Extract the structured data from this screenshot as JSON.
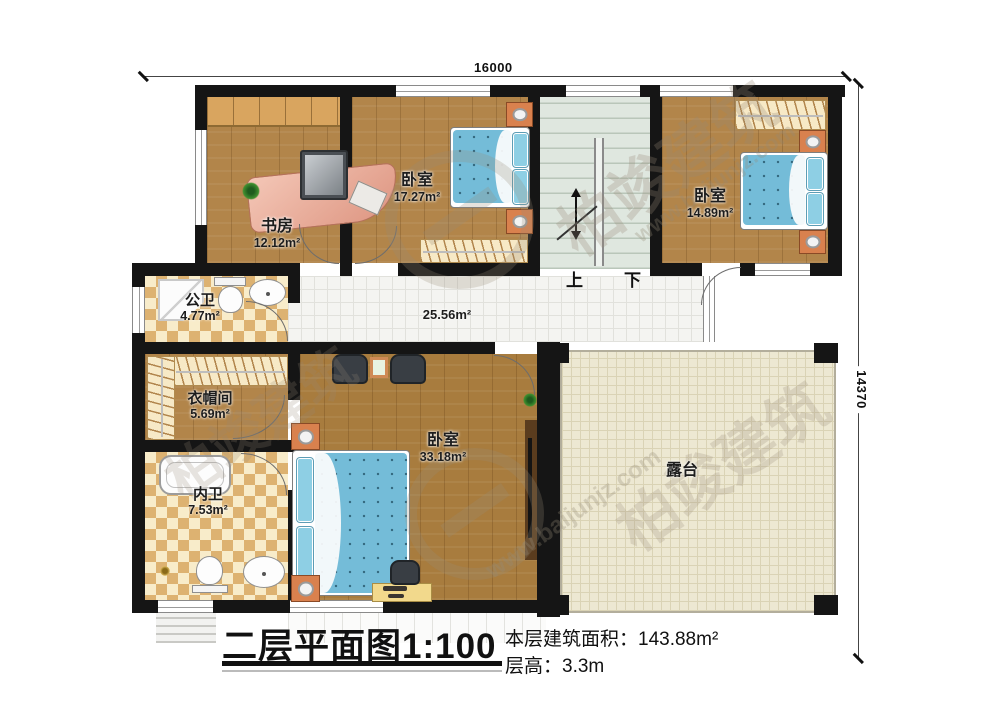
{
  "title_block": {
    "title": "二层平面图1:100",
    "area_label": "本层建筑面积：143.88m²",
    "floor_height_label": "层高：3.3m"
  },
  "dimensions": {
    "width": "16000",
    "height": "14370"
  },
  "rooms": {
    "study": {
      "name": "书房",
      "area": "12.12m²"
    },
    "bedroom1": {
      "name": "卧室",
      "area": "17.27m²"
    },
    "bedroom2": {
      "name": "卧室",
      "area": "14.89m²"
    },
    "public_bath": {
      "name": "公卫",
      "area": "4.77m²"
    },
    "hallway": {
      "area": "25.56m²"
    },
    "closet": {
      "name": "衣帽间",
      "area": "5.69m²"
    },
    "private_bath": {
      "name": "内卫",
      "area": "7.53m²"
    },
    "master": {
      "name": "卧室",
      "area": "33.18m²"
    },
    "terrace": {
      "name": "露台"
    }
  },
  "stairs": {
    "up": "上",
    "down": "下"
  },
  "watermark": {
    "brand": "柏竣建筑",
    "site": "www.baijunjz.com"
  },
  "colors": {
    "wall": "#151515",
    "bed": "#74bcd8",
    "nightstand": "#d9814e",
    "terrace": "#ede8d2",
    "stairs": "#dfe7df"
  }
}
